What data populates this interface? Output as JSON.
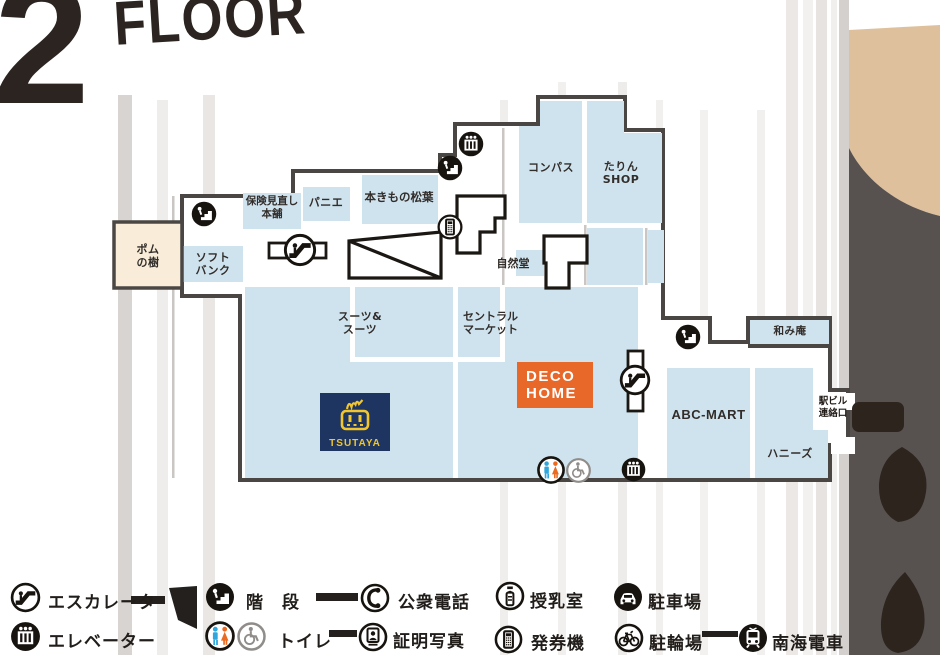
{
  "title": {
    "number": "2",
    "word": "FLOOR"
  },
  "colors": {
    "room_fill": "#cfe3ee",
    "outline": "#4a4644",
    "deco_bg": "#e8682a",
    "tsutaya_bg": "#1d3560",
    "tsutaya_yellow": "#f2c52d",
    "toilet_male": "#2fa7dc",
    "toilet_female": "#ea6a1f",
    "station_tan": "#dec19c",
    "station_gray": "#575250",
    "tree_brown": "#2e241e"
  },
  "map": {
    "rooms": {
      "pomunoki": {
        "l1": "ポム",
        "l2": "の樹"
      },
      "softbank": {
        "l1": "ソフト",
        "l2": "バンク"
      },
      "hoken": {
        "l1": "保険見直し",
        "l2": "本舗"
      },
      "panier": {
        "label": "パニエ"
      },
      "kimono": {
        "label": "本きもの松葉"
      },
      "compass": {
        "label": "コンパス"
      },
      "tarin": {
        "l1": "たりん",
        "l2": "SHOP"
      },
      "shizendo": {
        "label": "自然堂"
      },
      "suits": {
        "l1": "スーツ&",
        "l2": "スーツ"
      },
      "central": {
        "l1": "セントラル",
        "l2": "マーケット"
      },
      "decohome": {
        "l1": "DECO",
        "l2": "HOME"
      },
      "tsutaya": {
        "label": "TSUTAYA"
      },
      "nagomian": {
        "label": "和み庵"
      },
      "abcmart": {
        "label": "ABC-MART"
      },
      "honeys": {
        "label": "ハニーズ"
      }
    },
    "station_link": {
      "l1": "駅ビル",
      "l2": "連絡口"
    }
  },
  "legend": {
    "row1": [
      {
        "name": "escalator",
        "label": "エスカレータ"
      },
      {
        "name": "stairs",
        "label": "階　段"
      },
      {
        "name": "public-phone",
        "label": "公衆電話"
      },
      {
        "name": "nursing-room",
        "label": "授乳室"
      },
      {
        "name": "parking",
        "label": "駐車場"
      }
    ],
    "row2": [
      {
        "name": "elevator",
        "label": "エレベーター"
      },
      {
        "name": "toilet",
        "label": "トイレ"
      },
      {
        "name": "id-photo",
        "label": "証明写真"
      },
      {
        "name": "ticket-machine",
        "label": "発券機"
      },
      {
        "name": "bicycle-parking",
        "label": "駐輪場"
      },
      {
        "name": "nankai-train",
        "label": "南海電車"
      }
    ]
  }
}
